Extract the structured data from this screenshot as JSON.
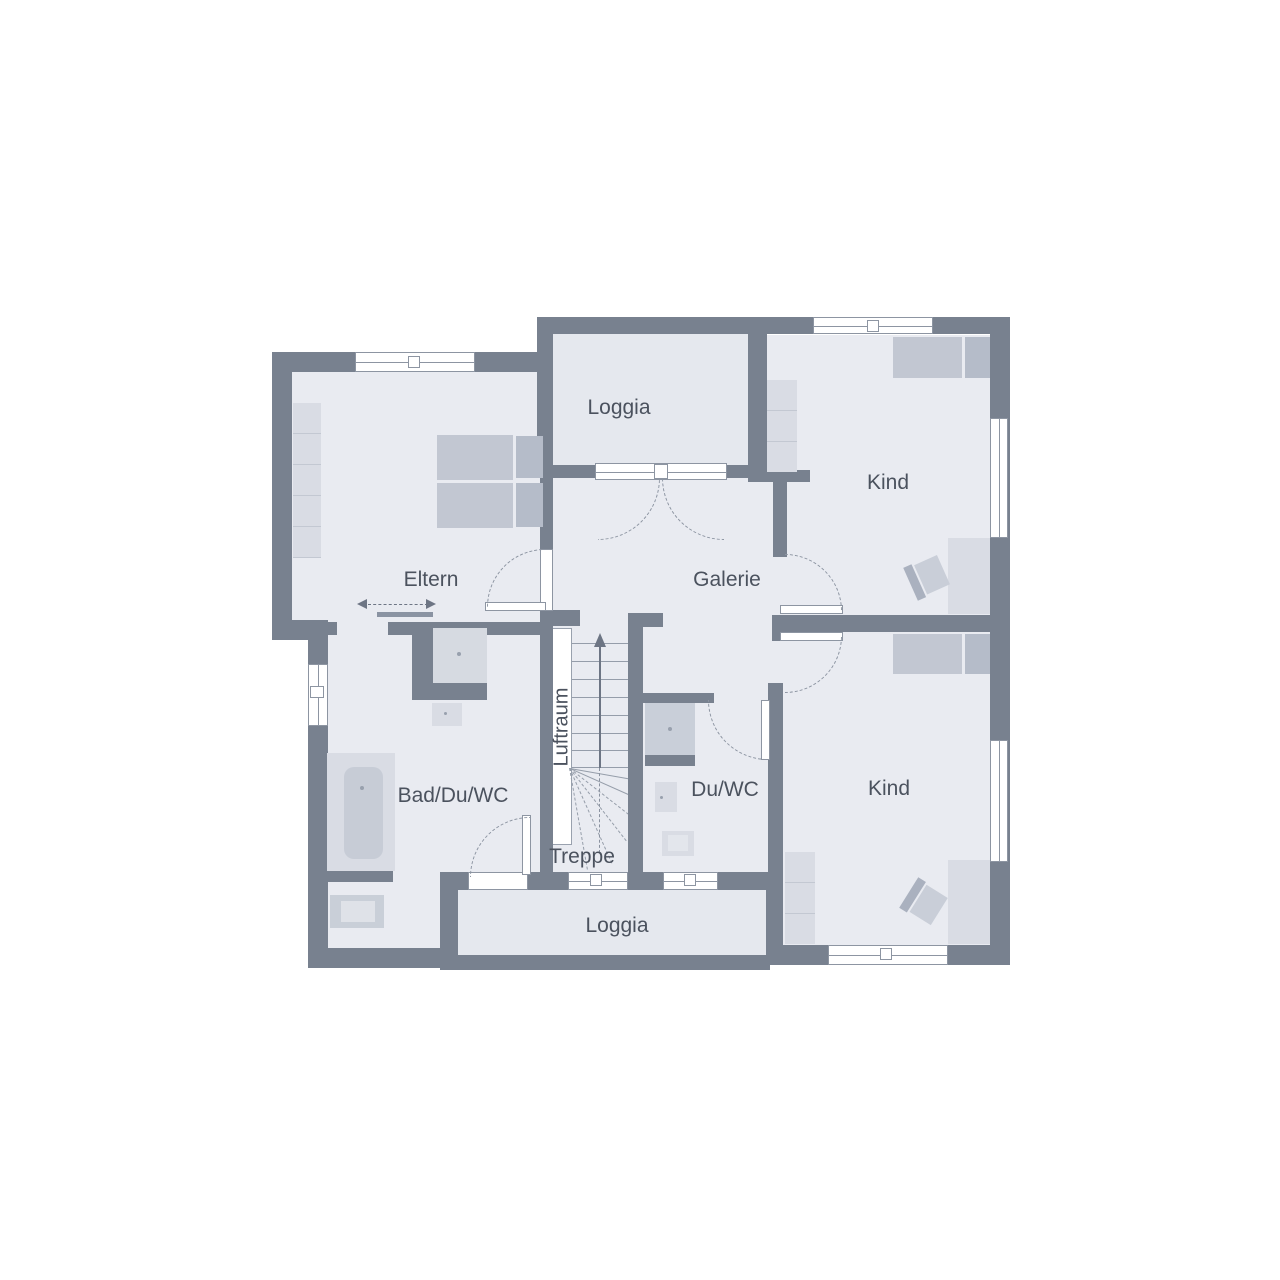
{
  "rooms": [
    {
      "id": "loggia-top",
      "label": "Loggia"
    },
    {
      "id": "kind-top",
      "label": "Kind"
    },
    {
      "id": "eltern",
      "label": "Eltern"
    },
    {
      "id": "galerie",
      "label": "Galerie"
    },
    {
      "id": "luftraum",
      "label": "Luftraum"
    },
    {
      "id": "bad-du-wc",
      "label": "Bad/Du/WC"
    },
    {
      "id": "du-wc",
      "label": "Du/WC"
    },
    {
      "id": "treppe",
      "label": "Treppe"
    },
    {
      "id": "kind-bottom",
      "label": "Kind"
    },
    {
      "id": "loggia-bottom",
      "label": "Loggia"
    }
  ],
  "colors": {
    "wall": "#78818f",
    "room_fill": "#e9ebf1",
    "loggia_fill": "#e5e8ee",
    "furniture_light": "#d9dce4",
    "furniture_medium": "#c2c7d2",
    "furniture_dark": "#b5bcc9",
    "label_text": "#4b525e",
    "dash_line": "#8d95a2",
    "background": "#ffffff"
  }
}
